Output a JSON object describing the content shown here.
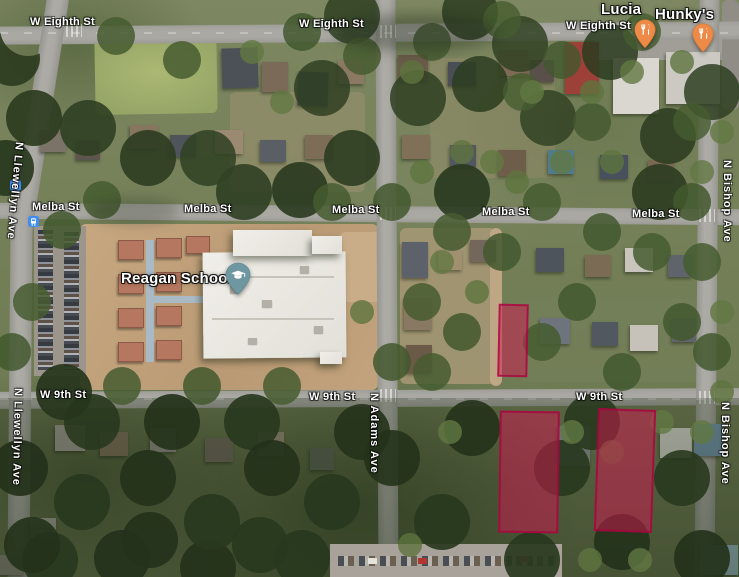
{
  "app": {
    "name": "satellite-map-view"
  },
  "streets": {
    "w_eighth_st": "W Eighth St",
    "melba_st": "Melba St",
    "w_9th_st": "W 9th St",
    "n_llewellyn_ave": "N Llewellyn Ave",
    "n_adams_ave": "N Adams Ave",
    "n_bishop_ave": "N Bishop Ave"
  },
  "pois": {
    "lucia": {
      "name": "Lucia",
      "category": "restaurant"
    },
    "hunkys": {
      "name": "Hunky's",
      "category": "restaurant"
    },
    "reagan_school": {
      "name": "Reagan School",
      "category": "school"
    }
  },
  "overlay": {
    "highlighted_parcels": 3,
    "fill_color": "#D2154F",
    "border_color": "#A6003E"
  },
  "icons": {
    "restaurant_pin_color": "#EE8A47",
    "school_pin_color": "#6F97A1",
    "transit_icon_color": "#3F8DF2"
  }
}
